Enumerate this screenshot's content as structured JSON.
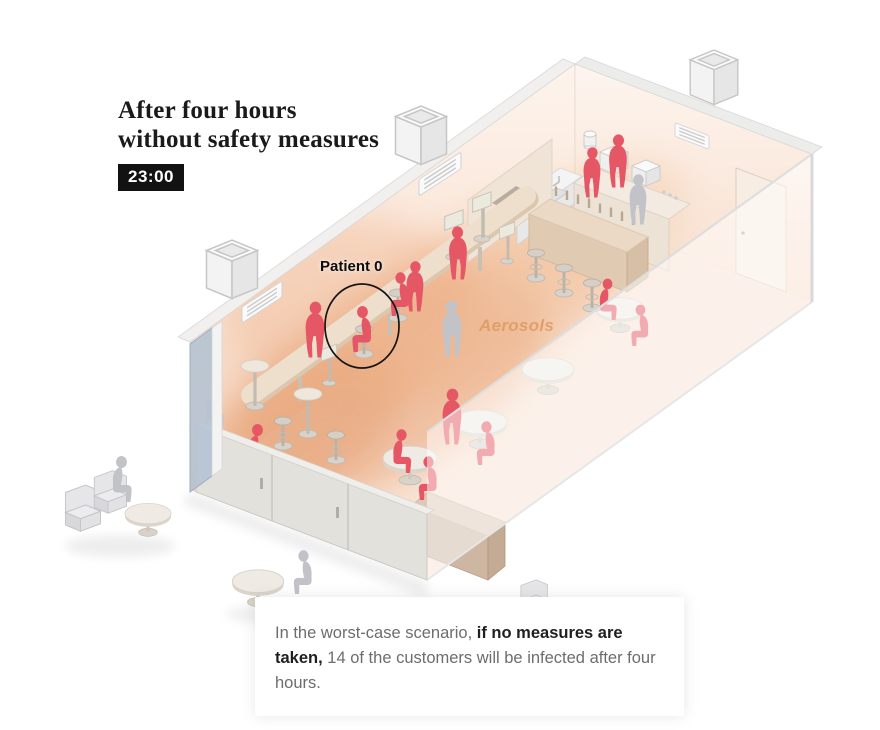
{
  "header": {
    "title_line1": "After four hours",
    "title_line2": "without safety measures",
    "time": "23:00"
  },
  "labels": {
    "patient_zero": "Patient 0",
    "aerosols": "Aerosols"
  },
  "caption": {
    "prefix": "In the worst-case scenario, ",
    "bold": "if no measures are taken,",
    "suffix": " 14 of the customers will be infected after four hours."
  },
  "stats": {
    "infected_customers": 14,
    "hours_elapsed": 4
  },
  "colors": {
    "infected": "#e65765",
    "healthy": "#c2c3c8",
    "aerosol_strong": "#e59d6e",
    "aerosol_soft": "#f3c7a3",
    "badge_bg": "#121212",
    "badge_text": "#ffffff",
    "title_text": "#1a1a1a",
    "aerosol_label": "#de975d",
    "caption_text": "#6d6d6d",
    "caption_bold": "#1f1f1f"
  },
  "scene": {
    "figures": [
      {
        "pose": "stand",
        "status": "infected",
        "x": 618,
        "y": 188,
        "s": 0.95,
        "flip": false,
        "layer": "inside"
      },
      {
        "pose": "stand",
        "status": "infected",
        "x": 592,
        "y": 198,
        "s": 0.9,
        "flip": false,
        "layer": "inside"
      },
      {
        "pose": "stand",
        "status": "infected",
        "x": 415,
        "y": 312,
        "s": 0.9,
        "flip": false,
        "layer": "inside"
      },
      {
        "pose": "stand",
        "status": "infected",
        "x": 458,
        "y": 280,
        "s": 0.95,
        "flip": true,
        "layer": "inside"
      },
      {
        "pose": "sit",
        "status": "infected",
        "x": 400,
        "y": 316,
        "s": 0.95,
        "flip": true,
        "layer": "inside"
      },
      {
        "pose": "sit",
        "status": "infected",
        "x": 362,
        "y": 352,
        "s": 1.0,
        "flip": true,
        "layer": "inside"
      },
      {
        "pose": "stand",
        "status": "infected",
        "x": 315,
        "y": 358,
        "s": 1.0,
        "flip": false,
        "layer": "inside"
      },
      {
        "pose": "sit",
        "status": "infected",
        "x": 258,
        "y": 470,
        "s": 1.0,
        "flip": false,
        "layer": "inside"
      },
      {
        "pose": "stand",
        "status": "infected",
        "x": 452,
        "y": 445,
        "s": 1.0,
        "flip": false,
        "layer": "inside"
      },
      {
        "pose": "sit",
        "status": "infected",
        "x": 486,
        "y": 465,
        "s": 0.95,
        "flip": true,
        "layer": "inside"
      },
      {
        "pose": "sit",
        "status": "infected",
        "x": 402,
        "y": 473,
        "s": 0.95,
        "flip": false,
        "layer": "inside"
      },
      {
        "pose": "sit",
        "status": "infected",
        "x": 428,
        "y": 500,
        "s": 0.95,
        "flip": true,
        "layer": "inside"
      },
      {
        "pose": "sit",
        "status": "infected",
        "x": 608,
        "y": 320,
        "s": 0.9,
        "flip": false,
        "layer": "inside"
      },
      {
        "pose": "sit",
        "status": "infected",
        "x": 640,
        "y": 346,
        "s": 0.9,
        "flip": true,
        "layer": "inside"
      },
      {
        "pose": "stand",
        "status": "healthy",
        "x": 638,
        "y": 225,
        "s": 0.9,
        "flip": false,
        "layer": "inside"
      },
      {
        "pose": "stand",
        "status": "healthy",
        "x": 452,
        "y": 357,
        "s": 1.0,
        "flip": true,
        "layer": "inside"
      },
      {
        "pose": "sit",
        "status": "healthy",
        "x": 215,
        "y": 428,
        "s": 0.9,
        "flip": false,
        "layer": "inside"
      },
      {
        "pose": "sit",
        "status": "healthy",
        "x": 122,
        "y": 502,
        "s": 1.0,
        "flip": false,
        "layer": "outside"
      },
      {
        "pose": "sit",
        "status": "healthy",
        "x": 303,
        "y": 594,
        "s": 0.95,
        "flip": true,
        "layer": "outside"
      }
    ]
  }
}
